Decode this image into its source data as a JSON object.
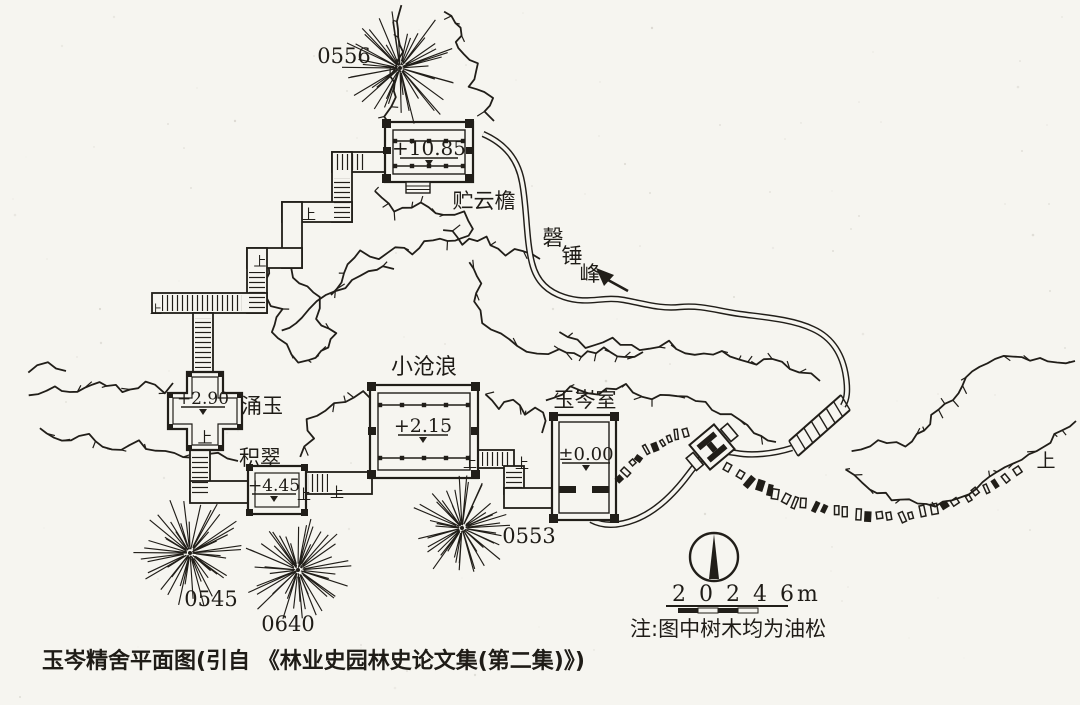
{
  "figure": {
    "caption": "玉岑精舍平面图(引自 《林业史园林史论文集(第二集)》)",
    "note": "注:图中树木均为油松",
    "scale_label": "2 0 2 4 6m",
    "colors": {
      "ink": "#211e19",
      "paper": "#f6f5f0"
    }
  },
  "buildings": [
    {
      "name": "贮云檐",
      "elevation": "+10.85"
    },
    {
      "name": "涌玉",
      "elevation": "+2.90"
    },
    {
      "name": "积翠",
      "elevation": "+4.45"
    },
    {
      "name": "小沧浪",
      "elevation": "+2.15"
    },
    {
      "name": "玉岑室",
      "elevation": "±0.00"
    }
  ],
  "peak": {
    "name": "磬锤峰",
    "chars": [
      "磬",
      "锤",
      "峰"
    ]
  },
  "trees": [
    {
      "id": "0556",
      "cx": 400,
      "cy": 68,
      "r": 60,
      "label_x": 344,
      "label_y": 63
    },
    {
      "id": "0545",
      "cx": 190,
      "cy": 553,
      "r": 55,
      "label_x": 211,
      "label_y": 606
    },
    {
      "id": "0640",
      "cx": 298,
      "cy": 570,
      "r": 55,
      "label_x": 288,
      "label_y": 631
    },
    {
      "id": "0553",
      "cx": 462,
      "cy": 528,
      "r": 52,
      "label_x": 529,
      "label_y": 543
    }
  ],
  "up_markers": {
    "label": "上",
    "points": [
      {
        "x": 309,
        "y": 214,
        "s": 14
      },
      {
        "x": 260,
        "y": 261,
        "s": 13
      },
      {
        "x": 156,
        "y": 309,
        "s": 12
      },
      {
        "x": 205,
        "y": 437,
        "s": 15
      },
      {
        "x": 304,
        "y": 494,
        "s": 14
      },
      {
        "x": 337,
        "y": 492,
        "s": 14
      },
      {
        "x": 470,
        "y": 462,
        "s": 14
      },
      {
        "x": 522,
        "y": 463,
        "s": 14
      },
      {
        "x": 1046,
        "y": 460,
        "s": 19
      }
    ]
  }
}
